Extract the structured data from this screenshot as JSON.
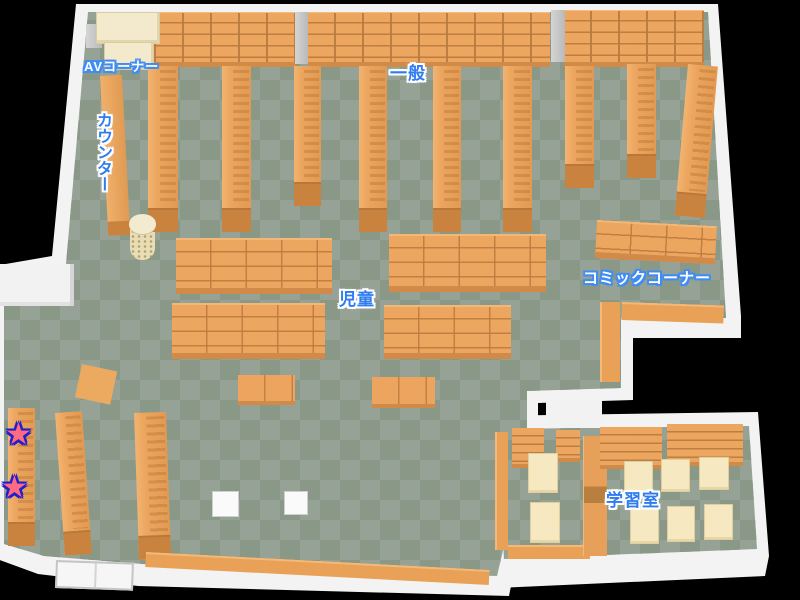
{
  "map_title": "library-floor-map",
  "labels": {
    "av_corner": "AVコーナー",
    "counter": "カウンター",
    "general": "一般",
    "children": "児童",
    "comic_corner": "コミックコーナー",
    "study_room": "学習室"
  },
  "palette": {
    "background": "#000000",
    "floor_light": "#95a295",
    "floor_dark": "#899887",
    "shelf_orange": "#eca660",
    "shelf_front": "#c9833f",
    "wall_white": "#f3f3f3",
    "cream": "#f3e9cd",
    "label_blue": "#2e7cf0",
    "label_outline_blue": "#3f8cf5",
    "star_pink": "#ff6b81",
    "star_outline": "#2121cc"
  },
  "markers": [
    {
      "name": "star-marker",
      "symbol": "★",
      "x": 5,
      "y": 420,
      "color": "#ff6b81",
      "outline": "#2121cc"
    },
    {
      "name": "star-marker",
      "symbol": "★",
      "x": 1,
      "y": 473,
      "color": "#ff6b81",
      "outline": "#2121cc"
    }
  ],
  "map_objects": [
    {
      "type": "wall-shelf",
      "name": "bookshelf-wall",
      "x": 128,
      "y": 12,
      "w": 168,
      "h": 50
    },
    {
      "type": "wall-shelf",
      "name": "bookshelf-wall",
      "x": 308,
      "y": 12,
      "w": 242,
      "h": 50
    },
    {
      "type": "wall-shelf",
      "name": "bookshelf-wall",
      "x": 564,
      "y": 10,
      "w": 140,
      "h": 52
    },
    {
      "type": "pillar",
      "name": "pillar",
      "x": 295,
      "y": 12,
      "w": 13,
      "h": 52
    },
    {
      "type": "pillar",
      "name": "pillar",
      "x": 551,
      "y": 10,
      "w": 14,
      "h": 52
    },
    {
      "type": "pillar",
      "name": "pillar",
      "x": 86,
      "y": 24,
      "w": 16,
      "h": 24
    },
    {
      "type": "cream-unit",
      "name": "av-shelf",
      "x": 96,
      "y": 12,
      "w": 62,
      "h": 30
    },
    {
      "type": "cream-unit",
      "name": "av-shelf",
      "x": 104,
      "y": 42,
      "w": 48,
      "h": 26
    },
    {
      "type": "counter",
      "name": "counter-desk",
      "x": 100,
      "y": 76,
      "w": 22,
      "h": 160,
      "rot": -3
    },
    {
      "type": "round-rack",
      "name": "round-rack",
      "x": 129,
      "y": 214,
      "w": 27,
      "h": 46
    },
    {
      "type": "aisle",
      "name": "bookshelf-aisle",
      "x": 148,
      "y": 66,
      "w": 30,
      "h": 166
    },
    {
      "type": "aisle",
      "name": "bookshelf-aisle",
      "x": 222,
      "y": 66,
      "w": 29,
      "h": 166
    },
    {
      "type": "aisle",
      "name": "bookshelf-aisle",
      "x": 294,
      "y": 66,
      "w": 27,
      "h": 140
    },
    {
      "type": "aisle",
      "name": "bookshelf-aisle",
      "x": 359,
      "y": 66,
      "w": 28,
      "h": 166
    },
    {
      "type": "aisle",
      "name": "bookshelf-aisle",
      "x": 433,
      "y": 66,
      "w": 28,
      "h": 166
    },
    {
      "type": "aisle",
      "name": "bookshelf-aisle",
      "x": 503,
      "y": 66,
      "w": 29,
      "h": 166
    },
    {
      "type": "aisle",
      "name": "bookshelf-aisle",
      "x": 565,
      "y": 66,
      "w": 29,
      "h": 122
    },
    {
      "type": "aisle",
      "name": "bookshelf-aisle",
      "x": 627,
      "y": 64,
      "w": 29,
      "h": 114
    },
    {
      "type": "aisle",
      "name": "bookshelf-wall-right",
      "x": 688,
      "y": 64,
      "w": 30,
      "h": 152,
      "rot": 5
    },
    {
      "type": "low-shelf",
      "name": "bookshelf-comic",
      "x": 597,
      "y": 220,
      "w": 120,
      "h": 32,
      "rot": 3
    },
    {
      "type": "strip",
      "name": "bookshelf-strip",
      "x": 622,
      "y": 302,
      "w": 102,
      "h": 18,
      "rot": 2
    },
    {
      "type": "strip-v",
      "name": "bookshelf-strip",
      "x": 600,
      "y": 302,
      "w": 20,
      "h": 80
    },
    {
      "type": "low-shelf",
      "name": "bookshelf-children",
      "x": 176,
      "y": 238,
      "w": 156,
      "h": 50
    },
    {
      "type": "low-shelf",
      "name": "bookshelf-children",
      "x": 389,
      "y": 234,
      "w": 157,
      "h": 52
    },
    {
      "type": "low-shelf",
      "name": "bookshelf-children",
      "x": 172,
      "y": 303,
      "w": 153,
      "h": 50
    },
    {
      "type": "low-shelf",
      "name": "bookshelf-children",
      "x": 384,
      "y": 305,
      "w": 127,
      "h": 48
    },
    {
      "type": "table-low",
      "name": "picture-book-table",
      "x": 238,
      "y": 375,
      "w": 57,
      "h": 26
    },
    {
      "type": "table-low",
      "name": "picture-book-table",
      "x": 372,
      "y": 377,
      "w": 63,
      "h": 27
    },
    {
      "type": "diamond",
      "name": "display-table",
      "x": 82,
      "y": 364,
      "w": 36,
      "h": 34,
      "rot": 12
    },
    {
      "type": "aisle",
      "name": "bookshelf-aisle",
      "x": 55,
      "y": 413,
      "w": 27,
      "h": 143,
      "rot": -4
    },
    {
      "type": "aisle",
      "name": "bookshelf-aisle",
      "x": 134,
      "y": 413,
      "w": 32,
      "h": 147,
      "rot": -2
    },
    {
      "type": "aisle",
      "name": "bookshelf-star-wall",
      "x": 8,
      "y": 408,
      "w": 27,
      "h": 138
    },
    {
      "type": "strip",
      "name": "bookshelf-strip",
      "x": 146,
      "y": 552,
      "w": 344,
      "h": 15,
      "rot": 3
    },
    {
      "type": "stool",
      "name": "stool",
      "x": 212,
      "y": 491,
      "w": 25,
      "h": 24
    },
    {
      "type": "stool",
      "name": "stool",
      "x": 284,
      "y": 491,
      "w": 22,
      "h": 22
    },
    {
      "type": "door",
      "name": "entrance-door",
      "x": 56,
      "y": 560,
      "w": 74,
      "h": 24,
      "rot": 2
    },
    {
      "type": "wall-stub",
      "name": "wall-partition",
      "x": 0,
      "y": 264,
      "w": 74,
      "h": 42
    },
    {
      "type": "wall-stub2",
      "name": "study-room-vestibule",
      "x": 546,
      "y": 400,
      "w": 56,
      "h": 28
    },
    {
      "type": "strip-v",
      "name": "bookshelf-strip",
      "x": 495,
      "y": 432,
      "w": 13,
      "h": 118
    },
    {
      "type": "strip",
      "name": "bookshelf-strip",
      "x": 508,
      "y": 545,
      "w": 82,
      "h": 14
    },
    {
      "type": "slat-shelf",
      "name": "shelf-unit",
      "x": 512,
      "y": 428,
      "w": 32,
      "h": 36
    },
    {
      "type": "slat-shelf",
      "name": "shelf-unit",
      "x": 556,
      "y": 430,
      "w": 24,
      "h": 28
    },
    {
      "type": "desk",
      "name": "study-table",
      "x": 528,
      "y": 453,
      "w": 28,
      "h": 38
    },
    {
      "type": "desk",
      "name": "study-table",
      "x": 530,
      "y": 502,
      "w": 28,
      "h": 39
    },
    {
      "type": "divider",
      "name": "divider-shelf",
      "x": 583,
      "y": 436,
      "w": 24,
      "h": 120
    },
    {
      "type": "slat-shelf",
      "name": "bookshelf-wall",
      "x": 600,
      "y": 427,
      "w": 62,
      "h": 38
    },
    {
      "type": "slat-shelf",
      "name": "bookshelf-wall",
      "x": 667,
      "y": 424,
      "w": 76,
      "h": 38
    },
    {
      "type": "desk",
      "name": "study-desk",
      "x": 624,
      "y": 461,
      "w": 27,
      "h": 31
    },
    {
      "type": "desk",
      "name": "study-desk",
      "x": 661,
      "y": 459,
      "w": 27,
      "h": 31
    },
    {
      "type": "desk",
      "name": "study-desk",
      "x": 699,
      "y": 457,
      "w": 28,
      "h": 31
    },
    {
      "type": "desk",
      "name": "study-desk",
      "x": 630,
      "y": 508,
      "w": 27,
      "h": 34
    },
    {
      "type": "desk",
      "name": "study-desk",
      "x": 667,
      "y": 506,
      "w": 26,
      "h": 34
    },
    {
      "type": "desk",
      "name": "study-desk",
      "x": 704,
      "y": 504,
      "w": 27,
      "h": 34
    }
  ]
}
